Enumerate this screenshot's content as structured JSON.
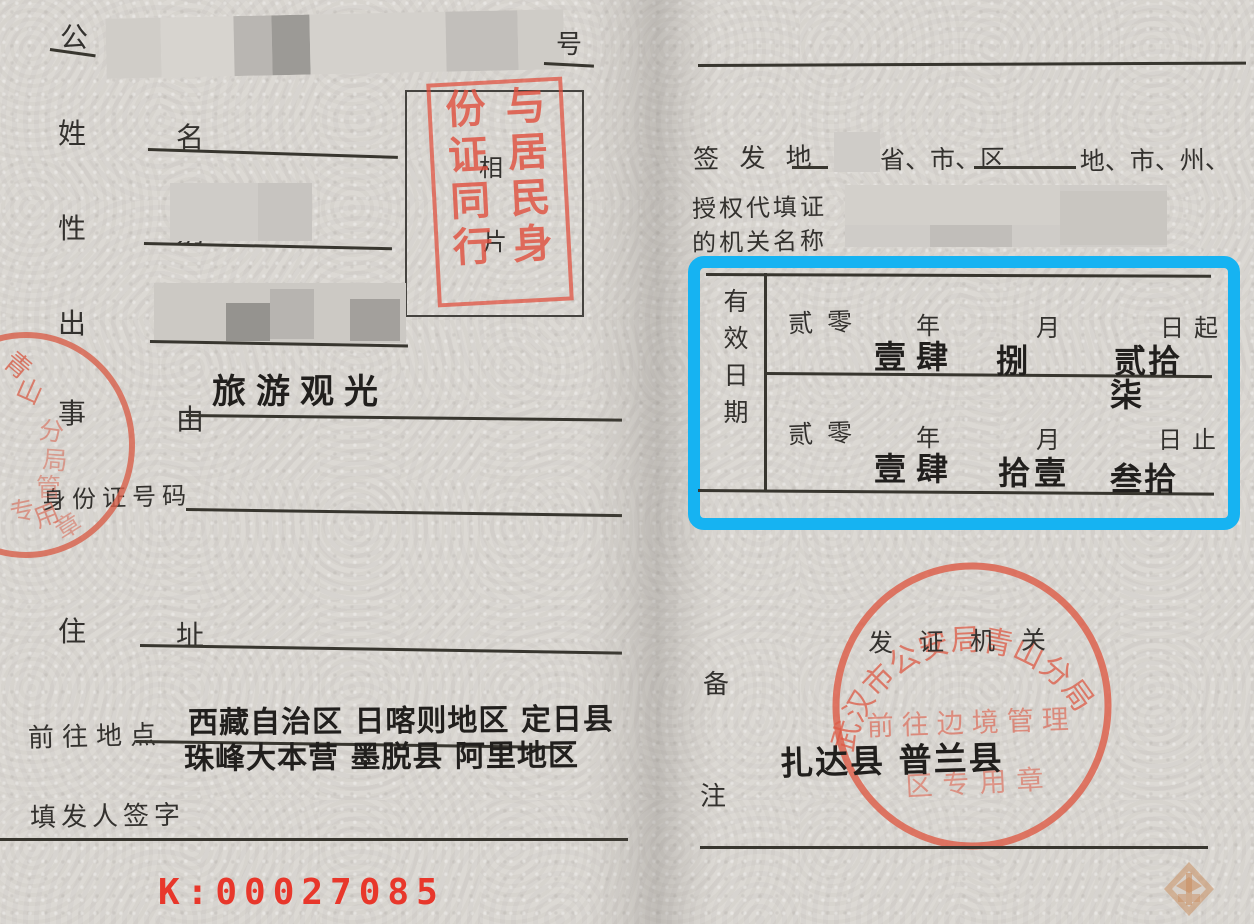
{
  "document": {
    "left_page": {
      "citizen_char": "公",
      "number_char": "号",
      "name_label": {
        "first": "姓",
        "second": "名"
      },
      "sex_label": {
        "first": "性",
        "second": "别"
      },
      "birth_label": {
        "first": "出",
        "second": "生"
      },
      "reason_label": {
        "first": "事",
        "second": "由"
      },
      "reason_value": "旅游观光",
      "id_label": "身份证号码",
      "address_label": {
        "first": "住",
        "second": "址"
      },
      "destination_label": "前往地点",
      "destination_line1": "西藏自治区 日喀则地区 定日县",
      "destination_line2": "珠峰大本营 墨脱县 阿里地区",
      "issuer_label": "填发人签字",
      "serial_number": "K:00027085",
      "photo_box": {
        "placeholder_top": "相",
        "placeholder_bottom": "片",
        "stamp_text": "与居民身份证同行"
      },
      "edge_stamp_chars": {
        "c1": "青",
        "c2": "山",
        "c3": "分",
        "c4": "局",
        "c5": "管",
        "c6": "专",
        "c7": "用",
        "c8": "章"
      }
    },
    "right_page": {
      "issue_place_label": "签 发 地",
      "issue_place_suffix1": "省、市、区",
      "issue_place_suffix2": "地、市、州、盟",
      "agency_label_line1": "授权代填证",
      "agency_label_line2": "的机关名称",
      "validity": {
        "label": "有效日期",
        "start": {
          "century": "贰零",
          "year_suffix": "年",
          "month_suffix": "月",
          "day_suffix": "日起",
          "year": "壹肆",
          "month": "捌",
          "day": "贰拾",
          "day_cont": "柒"
        },
        "end": {
          "century": "贰零",
          "year_suffix": "年",
          "month_suffix": "月",
          "day_suffix": "日止",
          "year": "壹肆",
          "month": "拾壹",
          "day": "叁拾"
        }
      },
      "authority_label": "发 证 机 关",
      "authority_stamp": {
        "arc_text": "武汉市公安局青山分局",
        "inner_line1": "前往边境管理",
        "inner_line2": "区专用章"
      },
      "remarks_label": {
        "first": "备",
        "second": "注"
      },
      "remarks_value": "扎达县 普兰县"
    },
    "colors": {
      "highlight_blue": "#16b3f2",
      "stamp_red": "#dd5a45",
      "serial_red": "#e8372b",
      "paper": "#d8d5d0"
    }
  }
}
